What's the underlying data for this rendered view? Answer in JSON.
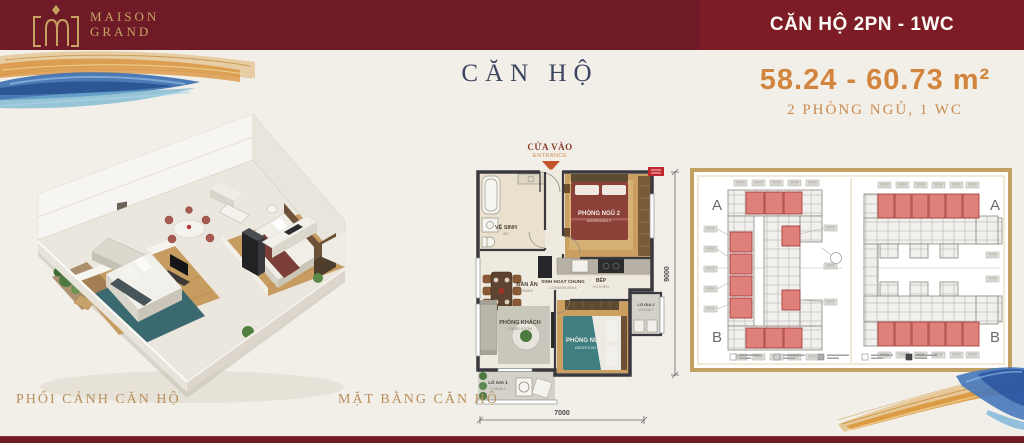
{
  "banner": {
    "brand": {
      "line1": "MAISON",
      "line2": "GRAND"
    },
    "unit_badge": "CĂN HỘ 2PN - 1WC"
  },
  "header": {
    "title": "CĂN HỘ",
    "area_range": "58.24 - 60.73 m²",
    "bedrooms": "2 PHÒNG NGỦ, 1 WC"
  },
  "perspective": {
    "caption": "PHỐI CẢNH CĂN HỘ"
  },
  "floorplan": {
    "caption": "MẶT BẰNG CĂN HỘ",
    "entrance": {
      "vi": "CỬA VÀO",
      "en": "ENTRANCE"
    },
    "dim_width": "7000",
    "dim_height": "9000",
    "rooms": {
      "wc": {
        "vi": "VỆ SINH",
        "en": "WC"
      },
      "bedroom2": {
        "vi": "PHÒNG NGỦ 2",
        "en": "BEDROOM 2"
      },
      "dining": {
        "vi": "BÀN ĂN",
        "en": "DINING"
      },
      "common": {
        "vi": "SINH HOẠT CHUNG",
        "en": "COMMON AREA"
      },
      "kitchen": {
        "vi": "BẾP",
        "en": "KITCHEN"
      },
      "living": {
        "vi": "PHÒNG KHÁCH",
        "en": "LIVING ROOM"
      },
      "bedroom1": {
        "vi": "PHÒNG NGỦ 1",
        "en": "BEDROOM 1"
      },
      "loggia1": {
        "vi": "LÔ GIA 1",
        "en": "LOGGIA 1"
      },
      "loggia2": {
        "vi": "LÔ GIA 2",
        "en": "LOGGIA 2"
      }
    }
  },
  "keyplan": {
    "labels": {
      "left_top": "A",
      "left_bottom": "B",
      "right_top": "A",
      "right_bottom": "B"
    }
  },
  "colors": {
    "banner_maroon": "#6f1b27",
    "badge_red": "#7e1c25",
    "gold": "#c8a263",
    "title_navy": "#3b4560",
    "accent_orange": "#d2853e",
    "caption_gold": "#b8905c",
    "keyplan_unit_red": "#e0807a",
    "frame_tan": "#c3a163"
  }
}
